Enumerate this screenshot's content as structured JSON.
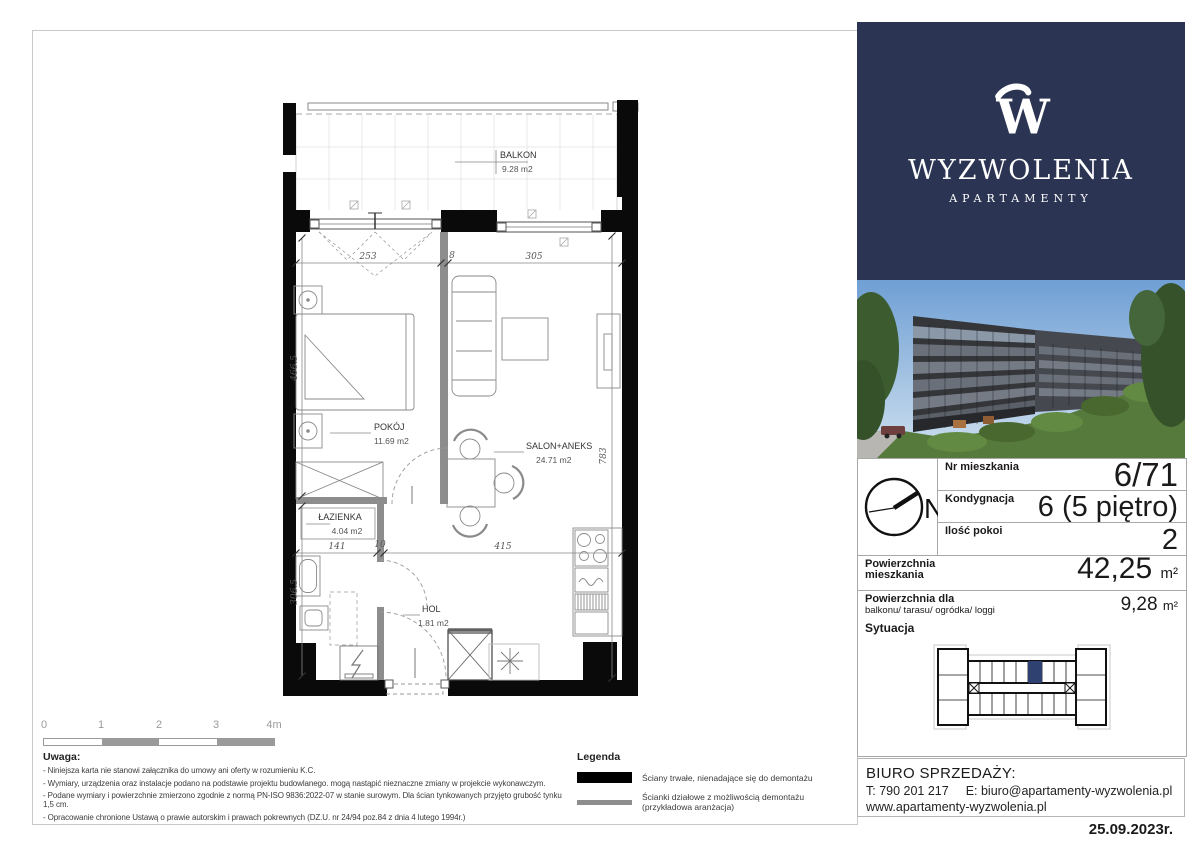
{
  "brand": {
    "monogram": "W",
    "name": "WYZWOLENIA",
    "subtitle": "APARTAMENTY"
  },
  "details": {
    "compass": "N",
    "rows": [
      {
        "label": "Nr mieszkania",
        "value": "6/71"
      },
      {
        "label": "Kondygnacja",
        "value": "6 (5 piętro)"
      },
      {
        "label": "Ilość pokoi",
        "value": "2"
      }
    ],
    "area": {
      "label1": "Powierzchnia",
      "label2": "mieszkania",
      "value": "42,25",
      "unit": "m²"
    },
    "balcony_area": {
      "label1": "Powierzchnia dla",
      "label2": "balkonu/ tarasu/ ogródka/ loggi",
      "value": "9,28",
      "unit": "m²"
    }
  },
  "situation": {
    "title": "Sytuacja"
  },
  "sales": {
    "title": "BIURO SPRZEDAŻY:",
    "phone": "T: 790 201 217",
    "email": "E: biuro@apartamenty-wyzwolenia.pl",
    "website": "www.apartamenty-wyzwolenia.pl"
  },
  "date": "25.09.2023r.",
  "plan": {
    "rooms": {
      "balkon": {
        "name": "BALKON",
        "area": "9.28 m2"
      },
      "pokoj": {
        "name": "POKÓJ",
        "area": "11.69 m2"
      },
      "salon": {
        "name": "SALON+ANEKS",
        "area": "24.71 m2"
      },
      "lazienka": {
        "name": "ŁAZIENKA",
        "area": "4.04 m2"
      },
      "hol": {
        "name": "HOL",
        "area": "1.81 m2"
      }
    },
    "dims": {
      "top1": "253",
      "top2": "8",
      "top3": "305",
      "left": "466.5",
      "right": "783",
      "mid1": "141",
      "mid2": "10",
      "mid3": "415",
      "bottom_left": "306.5"
    }
  },
  "scalebar": {
    "t0": "0",
    "t1": "1",
    "t2": "2",
    "t3": "3",
    "t4": "4m"
  },
  "notes": {
    "title": "Uwaga:",
    "items": [
      "- Niniejsza karta nie stanowi załącznika do umowy ani oferty w rozumieniu K.C.",
      "- Wymiary, urządzenia oraz instalacje podano na podstawie projektu budowlanego. mogą nastąpić  nieznaczne zmiany w projekcie wykonawczym.",
      "- Podane wymiary i powierzchnie zmierzono zgodnie z normą PN-ISO 9836:2022-07 w stanie surowym. Dla ścian tynkowanych przyjęto grubość tynku 1,5 cm.",
      "- Opracowanie chronione Ustawą o prawie autorskim i prawach pokrewnych (DZ.U. nr 24/94 poz.84 z dnia 4 lutego 1994r.)"
    ]
  },
  "legend": {
    "title": "Legenda",
    "items": [
      {
        "label": "Ściany trwałe, nienadające się do demontażu"
      },
      {
        "label": "Ścianki działowe z możliwością demontażu (przykładowa aranżacja)"
      }
    ]
  },
  "colors": {
    "navy": "#2b3452",
    "highlight": "#2e4170"
  }
}
